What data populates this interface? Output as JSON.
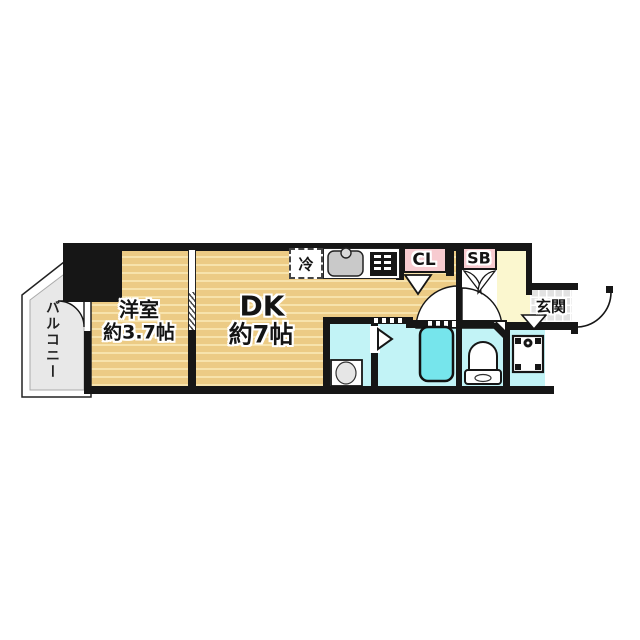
{
  "floorplan": {
    "type": "1DK apartment floor plan",
    "rooms": {
      "balcony": {
        "label": "バルコニー"
      },
      "western_room": {
        "label": "洋室",
        "area": "約3.7帖"
      },
      "dining_kitchen": {
        "label": "DK",
        "area": "約7帖"
      },
      "entrance": {
        "label": "玄関"
      },
      "closet": {
        "label": "CL"
      },
      "shoe_box": {
        "label": "SB"
      },
      "refrigerator_space": {
        "label": "冷"
      }
    },
    "fixtures": [
      "kitchen-sink",
      "gas-stove",
      "bathtub",
      "washbasin",
      "toilet",
      "washing-machine-pan",
      "door-swing-arcs",
      "sliding-partition",
      "pipe-shaft"
    ],
    "colors": {
      "flooring": "#ECCB85",
      "flooring_stripe": "#F7E3AC",
      "wall": "#161616",
      "wet_area": "#C2F3F6",
      "bathtub": "#76E5EC",
      "storage_pink": "#F7CBD0",
      "hall_cream": "#FBF7CF",
      "balcony_gray": "#E8E8E8",
      "entrance_tile": "#E2E2E2",
      "sink_gray": "#C9C9C9"
    }
  }
}
